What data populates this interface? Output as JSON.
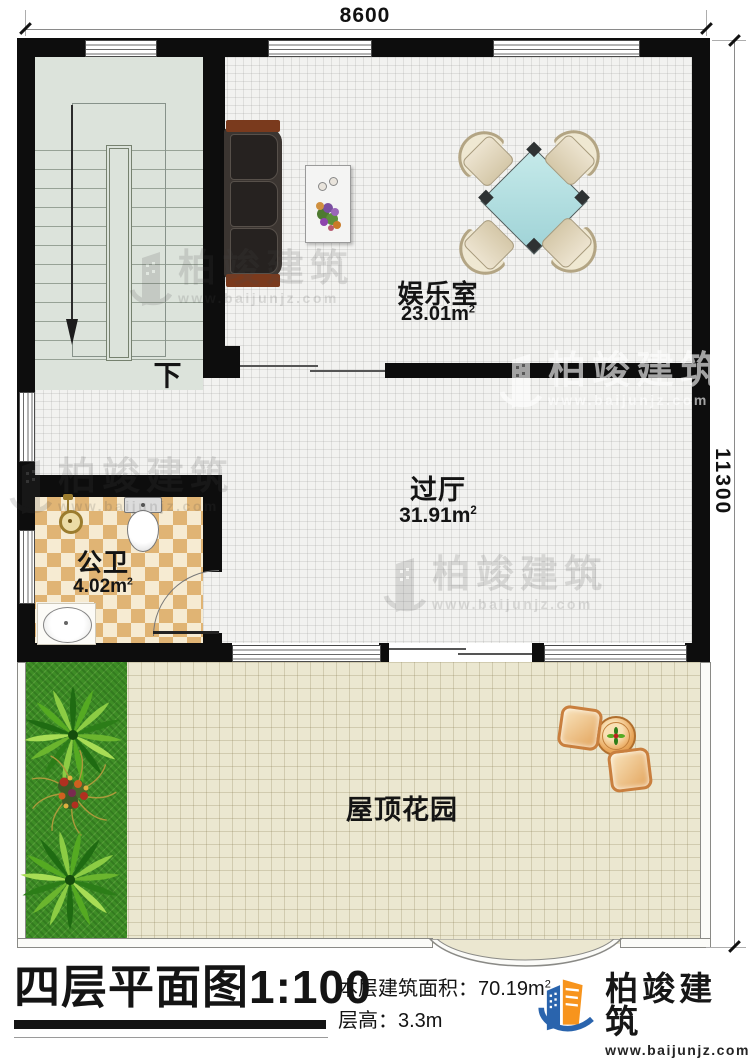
{
  "plan": {
    "dimensions": {
      "top": "8600",
      "right": "11300"
    },
    "stair_down_label": "下",
    "rooms": {
      "entertainment": {
        "name": "娱乐室",
        "area": "23.01m",
        "area_sup": "2"
      },
      "hall": {
        "name": "过厅",
        "area": "31.91m",
        "area_sup": "2"
      },
      "bathroom": {
        "name": "公卫",
        "area": "4.02m",
        "area_sup": "2"
      },
      "roof_garden": {
        "name": "屋顶花园"
      }
    }
  },
  "watermark": {
    "brand": "柏竣建筑",
    "url": "www.baijunjz.com"
  },
  "footer": {
    "title": "四层平面图",
    "scale": "1:100",
    "area_label": "本层建筑面积：",
    "area_value": "70.19m",
    "area_sup": "2",
    "height_label": "层高：",
    "height_value": "3.3m",
    "brand": "柏竣建筑",
    "brand_url": "www.baijunjz.com"
  },
  "colors": {
    "wall": "#0d0d0d",
    "floor_main": "#f2f2f0",
    "stair_floor": "#dce3db",
    "bath_dark": "#e0b474",
    "bath_light": "#f6ebd2",
    "garden_floor": "#ebe7d0",
    "grass": "#3e8d26",
    "table_teal": "#a9dcdc",
    "wood": "#7a3a1d",
    "logo_blue": "#2a64ad",
    "logo_orange": "#f7941d"
  }
}
